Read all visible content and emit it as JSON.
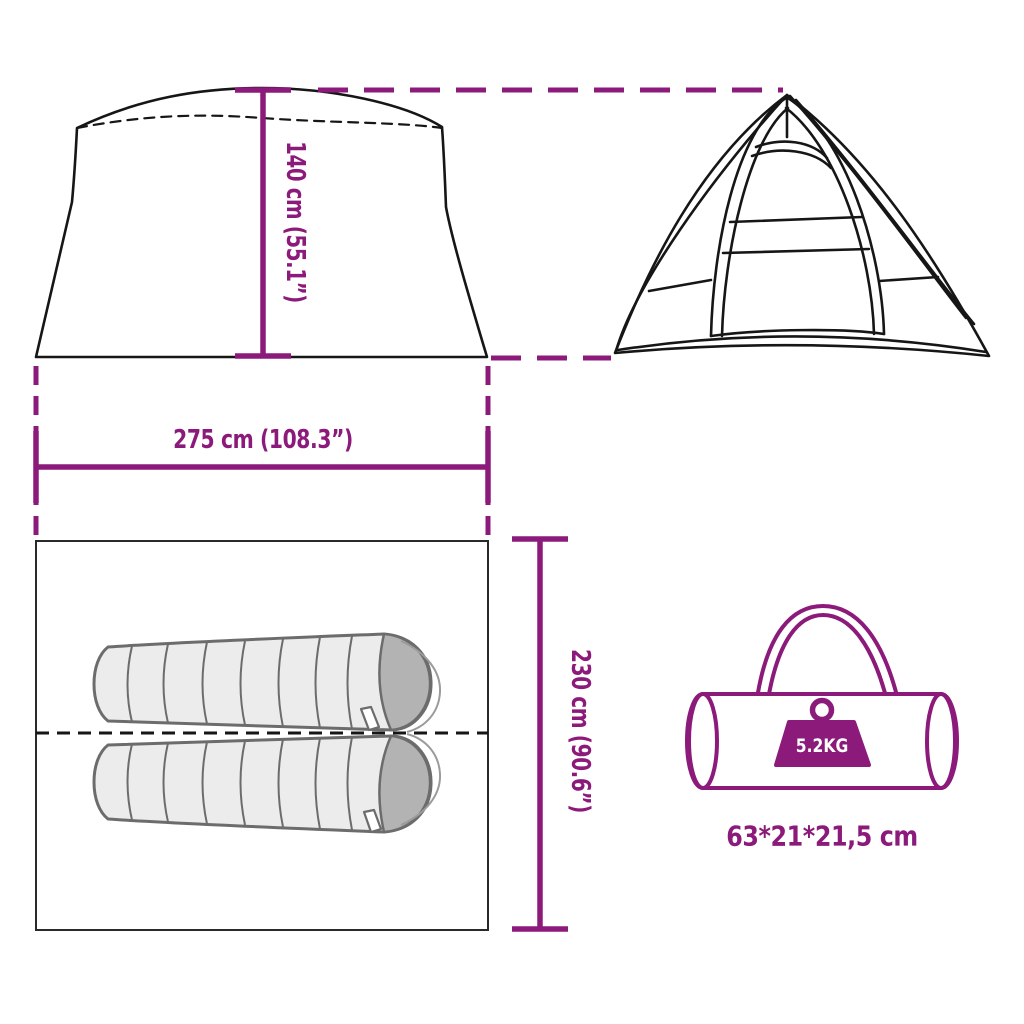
{
  "diagram": {
    "background": "#ffffff"
  },
  "colors": {
    "accent": "#8C1A7B",
    "outline": "#161616",
    "floor_outline": "#2a2a2a",
    "bag_fill": "#ececec",
    "bag_stroke": "#6c6c6c",
    "hood_fill": "#b3b3b3",
    "weight_text": "#ffffff"
  },
  "labels": {
    "height": "140 cm (55.1”)",
    "width": "275 cm (108.3”)",
    "depth": "230 cm (90.6”)",
    "weight": "5.2KG",
    "packed_size": "63*21*21,5 cm"
  },
  "icons": {
    "side_view": "tent-side-view-icon",
    "front_view": "tent-front-view-icon",
    "floor_plan": "tent-floor-plan",
    "sleeping_bags": "sleeping-bag-icon",
    "carry_bag": "carry-bag-icon",
    "weight": "weight-icon"
  }
}
